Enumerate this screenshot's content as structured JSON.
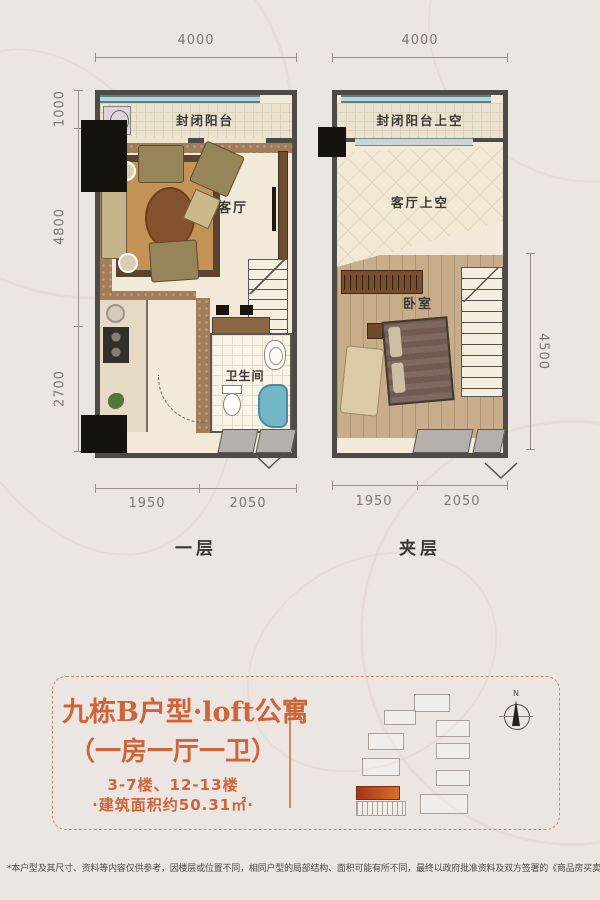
{
  "page": {
    "background": "#ece6e2",
    "accent": "#cf6438"
  },
  "plan_first": {
    "name": "一层",
    "dim_top": "4000",
    "dim_left_1": "1000",
    "dim_left_2": "4800",
    "dim_left_3": "2700",
    "dim_bottom_1": "1950",
    "dim_bottom_2": "2050",
    "room_balcony": "封闭阳台",
    "room_living": "客厅",
    "room_bath": "卫生间"
  },
  "plan_mezz": {
    "name": "夹层",
    "dim_top": "4000",
    "dim_right": "4500",
    "dim_bottom_1": "1950",
    "dim_bottom_2": "2050",
    "room_balcony_void": "封闭阳台上空",
    "room_living_void": "客厅上空",
    "room_bedroom": "卧室"
  },
  "info": {
    "title": "九栋B户型·loft公寓",
    "subtitle": "（一房一厅一卫）",
    "floors": "3-7楼、12-13楼",
    "area": "·建筑面积约50.31㎡·"
  },
  "siteplan": {
    "north": "N"
  },
  "disclaimer": "*本户型及其尺寸、资料等内容仅供参考，因楼层或位置不同，相同户型的局部结构、面积可能有所不同，最终以政府批准资料及双方签署的《商品房买卖合同》为准。"
}
